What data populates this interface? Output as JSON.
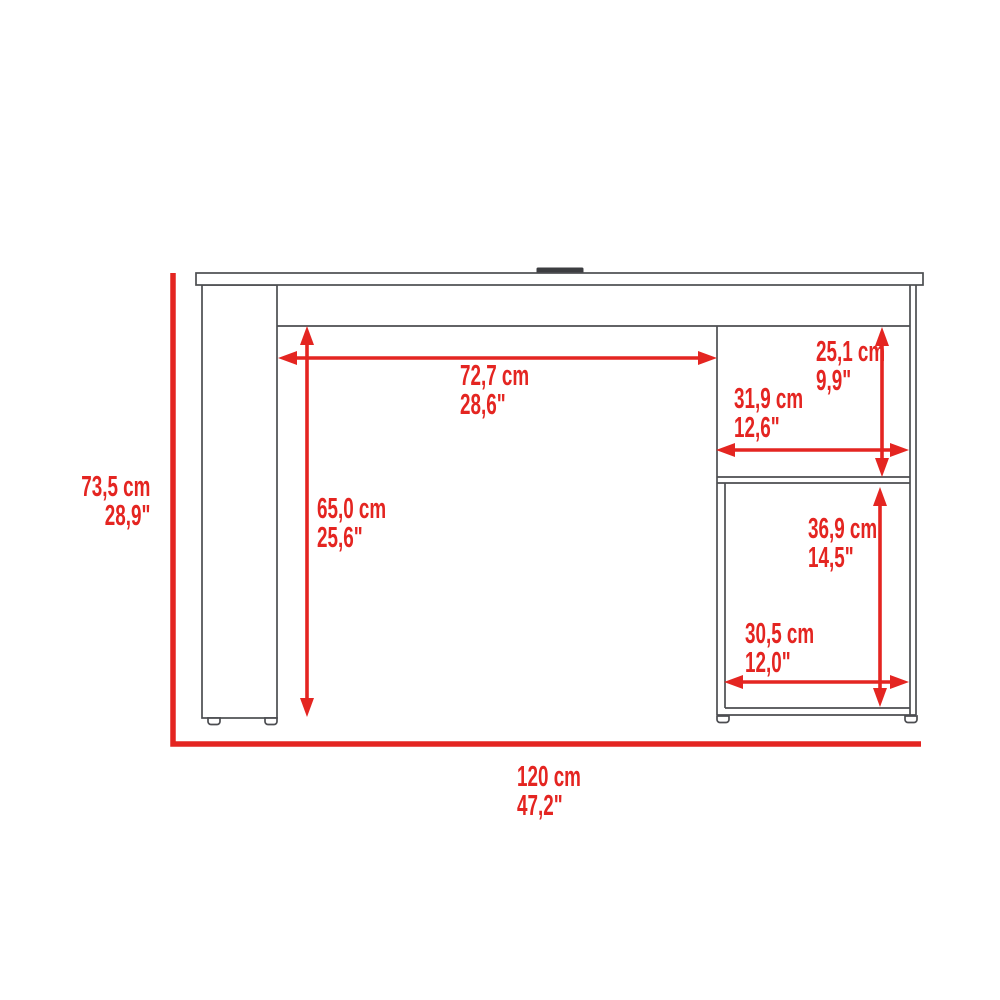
{
  "colors": {
    "dimension_red": "#e42521",
    "outline_gray": "#4c4d51",
    "grommet_dark": "#3c3d40",
    "background": "#ffffff"
  },
  "diagram": {
    "type": "furniture-dimension-diagram",
    "dimensions": {
      "overall_height": {
        "cm": "73,5 cm",
        "inches": "28,9\""
      },
      "overall_width": {
        "cm": "120 cm",
        "inches": "47,2\""
      },
      "desktop_clearance_width": {
        "cm": "72,7 cm",
        "inches": "28,6\""
      },
      "desktop_clearance_height": {
        "cm": "65,0 cm",
        "inches": "25,6\""
      },
      "upper_shelf_height": {
        "cm": "25,1 cm",
        "inches": "9,9\""
      },
      "upper_shelf_width": {
        "cm": "31,9 cm",
        "inches": "12,6\""
      },
      "lower_shelf_height": {
        "cm": "36,9 cm",
        "inches": "14,5\""
      },
      "lower_shelf_width": {
        "cm": "30,5 cm",
        "inches": "12,0\""
      }
    }
  }
}
